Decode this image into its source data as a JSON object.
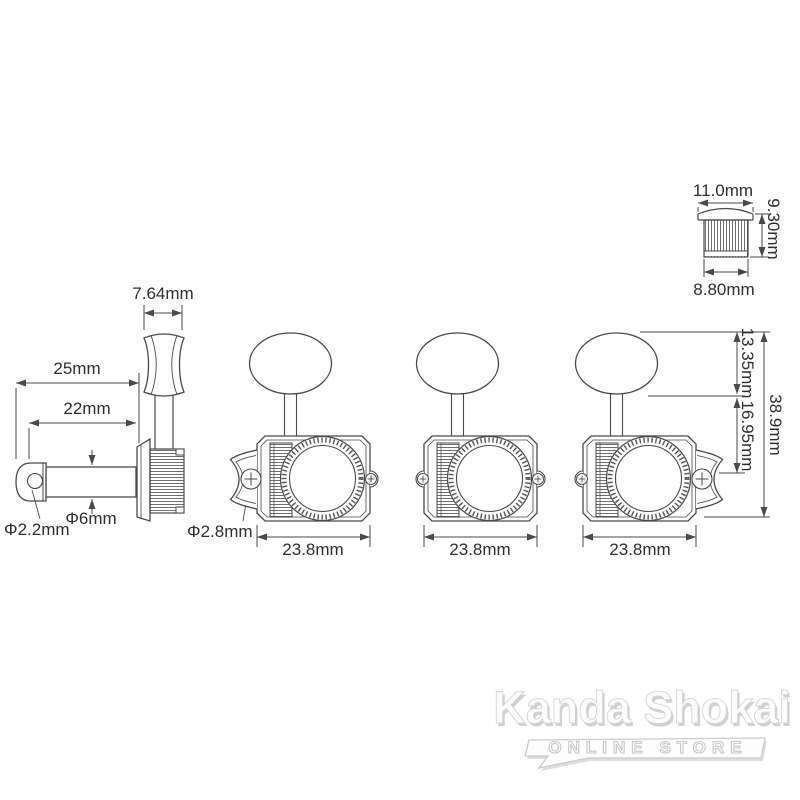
{
  "measurements": {
    "knob_thickness": "7.64mm",
    "post_total_length": "25mm",
    "post_length": "22mm",
    "string_hole_dia": "Φ2.2mm",
    "post_dia": "Φ6mm",
    "screw_hole_dia": "Φ2.8mm",
    "body_widths": [
      "23.8mm",
      "23.8mm",
      "23.8mm"
    ],
    "button_height": "13.35mm",
    "housing_height": "16.95mm",
    "overall_height": "38.9mm",
    "bushing_top_dia": "11.0mm",
    "bushing_height": "9.30mm",
    "bushing_body_dia": "8.80mm"
  },
  "watermark": {
    "brand": "Kanda Shokai",
    "subtitle": "ONLINE STORE"
  },
  "colors": {
    "line": "#4a4a4a",
    "text": "#2e2e2e",
    "background": "#ffffff",
    "watermark": "#cccccc"
  }
}
